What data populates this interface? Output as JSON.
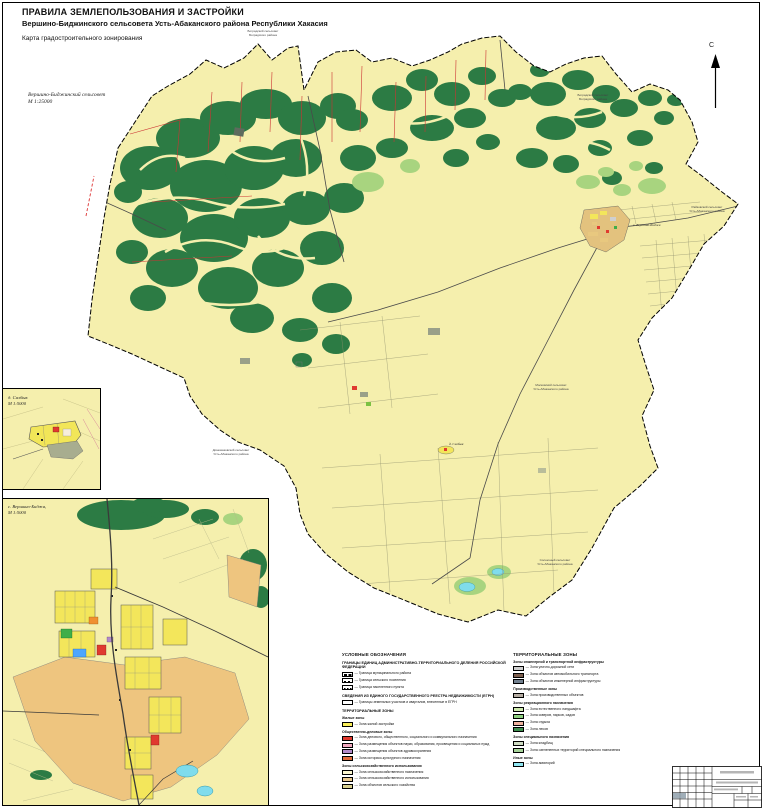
{
  "document": {
    "title": "ПРАВИЛА ЗЕМЛЕПОЛЬЗОВАНИЯ И ЗАСТРОЙКИ",
    "subtitle": "Вершино-Биджинского сельсовета Усть-Абаканского района Республики Хакасия",
    "map_name": "Карта градостроительного зонирования"
  },
  "main_map": {
    "area_label": "Вершино-Биджинский сельсовет",
    "area_scale": "М 1:25000",
    "north_label": "С",
    "settlement_labels": [
      {
        "name": "с. Вершино-Биджа"
      },
      {
        "name": "д. Салбык"
      }
    ],
    "adjacent_labels": [
      {
        "line1": "Боградский сельсовет",
        "line2": "Боградского района"
      },
      {
        "line1": "Боградский сельсовет",
        "line2": "Боградского района"
      },
      {
        "line1": "Райковский сельсовет",
        "line2": "Усть-Абаканского района"
      },
      {
        "line1": "Московский сельсовет",
        "line2": "Усть-Абаканского района"
      },
      {
        "line1": "Доможаковский сельсовет",
        "line2": "Усть-Абаканского района"
      },
      {
        "line1": "Солнечный сельсовет",
        "line2": "Усть-Абаканского района"
      }
    ]
  },
  "insets": {
    "salbyk": {
      "label": "д. Салбык",
      "scale": "М 1:5000"
    },
    "vershino_bidzha": {
      "label": "с. Вершино-Биджа,",
      "scale": "М 1:5000"
    }
  },
  "legend": {
    "title": "УСЛОВНЫЕ ОБОЗНАЧЕНИЯ",
    "left": {
      "boundaries_header": "ГРАНИЦЫ ЕДИНИЦ АДМИНИСТРАТИВНО-ТЕРРИТОРИАЛЬНОГО ДЕЛЕНИЯ РОССИЙСКОЙ ФЕДЕРАЦИИ",
      "boundaries": [
        {
          "label": "Граница муниципального района"
        },
        {
          "label": "Граница сельского поселения"
        },
        {
          "label": "Граница населенного пункта"
        }
      ],
      "egrn_header": "СВЕДЕНИЯ ИЗ ЕДИНОГО ГОСУДАРСТВЕННОГО РЕЕСТРА НЕДВИЖИМОСТИ (ЕГРН)",
      "egrn_items": [
        {
          "label": "Границы земельных участков и кварталов, внесенные в ЕГРН",
          "color": "#ffffff"
        }
      ],
      "zones_header": "ТЕРРИТОРИАЛЬНЫЕ ЗОНЫ",
      "groups": [
        {
          "title": "Жилые зоны",
          "items": [
            {
              "label": "Зона жилой застройки",
              "color": "#f9ee58"
            }
          ]
        },
        {
          "title": "Общественно-деловые зоны",
          "items": [
            {
              "label": "Зона делового, общественного, социального и коммунального назначения",
              "color": "#e0392e"
            },
            {
              "label": "Зона размещения объектов науки, образования, просвещения и социальных нужд",
              "color": "#f2aac0"
            },
            {
              "label": "Зона размещения объектов здравоохранения",
              "color": "#b28ac9"
            },
            {
              "label": "Зона историко-культурного назначения",
              "color": "#e06a3a"
            }
          ]
        },
        {
          "title": "Зоны сельскохозяйственного использования",
          "items": [
            {
              "label": "Зона сельскохозяйственного назначения",
              "color": "#fbf6cf"
            },
            {
              "label": "Зона сельскохозяйственного использования",
              "color": "#e9c98f"
            },
            {
              "label": "Зона объектов сельского хозяйства",
              "color": "#d8d08f"
            }
          ]
        }
      ]
    },
    "right": {
      "zones_header": "ТЕРРИТОРИАЛЬНЫЕ ЗОНЫ",
      "groups": [
        {
          "title": "Зоны инженерной и транспортной инфраструктуры",
          "items": [
            {
              "label": "Зона улично-дорожной сети",
              "color": "#cfcfcf"
            },
            {
              "label": "Зона объектов автомобильного транспорта",
              "color": "#7d5f4e"
            },
            {
              "label": "Зона объектов инженерной инфраструктуры",
              "color": "#72808f"
            }
          ]
        },
        {
          "title": "Производственные зоны",
          "items": [
            {
              "label": "Зона производственных объектов",
              "color": "#b5aca2"
            }
          ]
        },
        {
          "title": "Зоны рекреационного назначения",
          "items": [
            {
              "label": "Зона естественного ландшафта",
              "color": "#cde9ad"
            },
            {
              "label": "Зона скверов, парков, садов",
              "color": "#8ed080"
            },
            {
              "label": "Зона отдыха",
              "color": "#f0b3a0"
            },
            {
              "label": "Зона лесов",
              "color": "#3f8f4f"
            }
          ]
        },
        {
          "title": "Зоны специального назначения",
          "items": [
            {
              "label": "Зона кладбищ",
              "color": "#cfdcc3"
            },
            {
              "label": "Зона озелененных территорий специального назначения",
              "color": "#a7d49a"
            }
          ]
        },
        {
          "title": "Иные зоны",
          "items": [
            {
              "label": "Зона акваторий",
              "color": "#8fe6f2"
            }
          ]
        }
      ]
    }
  },
  "palette": {
    "map_background": "#f5efad",
    "forest_green": "#2c7b44",
    "light_green": "#a8d47f",
    "water_cyan": "#7fdcec",
    "cadastral_red": "#cc3333",
    "residential_yellow": "#f3e65b",
    "public_red": "#e03a2f",
    "farmland_tan": "#eec57f"
  }
}
